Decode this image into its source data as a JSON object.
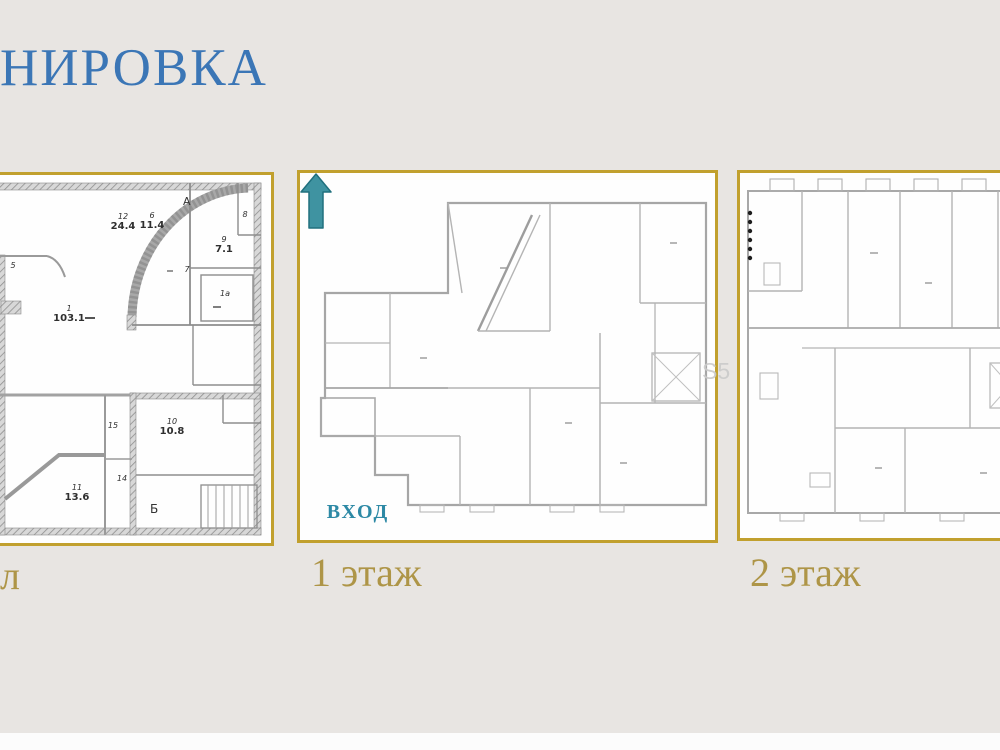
{
  "title": "НИРОВКА",
  "watermark": "S5",
  "colors": {
    "background": "#e8e5e2",
    "title_blue": "#3b76b6",
    "caption_gold": "#ae9547",
    "panel_border_gold": "#c1a02e",
    "arrow_teal": "#3f93a1",
    "entrance_text_teal": "#2d89a5"
  },
  "panels": {
    "basement": {
      "caption": "л",
      "axis_labels": {
        "top": "А",
        "bottom": "Б"
      },
      "rooms": [
        {
          "num": "12",
          "area": "24.4"
        },
        {
          "num": "6",
          "area": "11.4"
        },
        {
          "num": "9",
          "area": "7.1"
        },
        {
          "num": "1",
          "area": "103.1"
        },
        {
          "num": "5",
          "area": ""
        },
        {
          "num": "7",
          "area": ""
        },
        {
          "num": "8",
          "area": ""
        },
        {
          "num": "1а",
          "area": ""
        },
        {
          "num": "15",
          "area": ""
        },
        {
          "num": "10",
          "area": "10.8"
        },
        {
          "num": "14",
          "area": ""
        },
        {
          "num": "11",
          "area": "13.6"
        }
      ]
    },
    "floor1": {
      "caption": "1 этаж",
      "entrance_label": "ВХОД"
    },
    "floor2": {
      "caption": "2 этаж"
    }
  }
}
